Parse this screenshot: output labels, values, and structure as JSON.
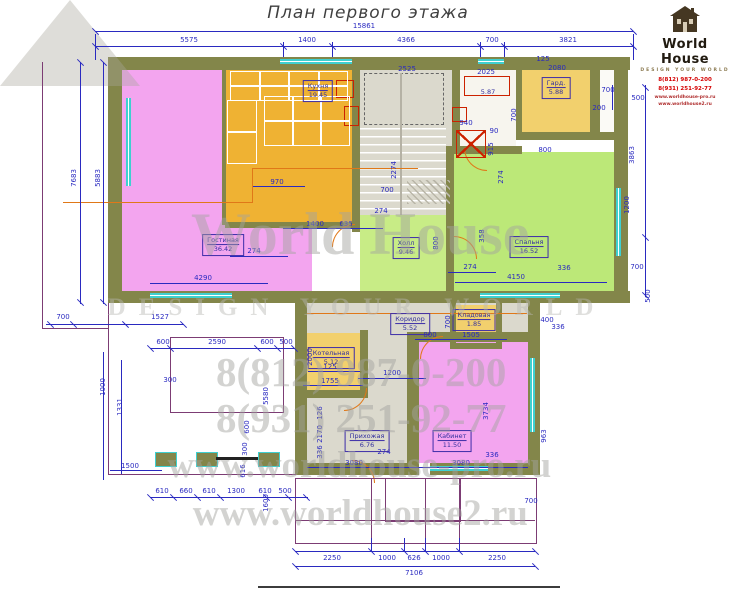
{
  "title": "План первого этажа",
  "logo": {
    "name": "World House",
    "tagline": "DESIGN YOUR WORLD",
    "phone1": "8(812) 987-0-200",
    "phone2": "8(931) 251-92-77",
    "site1": "www.worldhouse-pro.ru",
    "site2": "www.worldhouse2.ru"
  },
  "watermark": {
    "line1": "World House",
    "line2": "DESIGN YOUR WORLD",
    "line3": "8(812) 987-0-200",
    "line4": "8(931) 251-92-77",
    "line5": "www.worldhouse-pro.ru",
    "line6": "www.worldhouse2.ru"
  },
  "rooms": [
    {
      "name": "Кухня",
      "area": "19.45",
      "cx": 318,
      "cy": 91
    },
    {
      "name": "Гостиная",
      "area": "36.42",
      "cx": 223,
      "cy": 245
    },
    {
      "name": "Холл",
      "area": "9.46",
      "cx": 406,
      "cy": 248
    },
    {
      "name": "Спальня",
      "area": "16.52",
      "cx": 529,
      "cy": 247
    },
    {
      "name": "Гард.",
      "area": "5.88",
      "cx": 556,
      "cy": 88
    },
    {
      "name": "",
      "area": "5.87",
      "cx": 488,
      "cy": 92,
      "plain": true
    },
    {
      "name": "Котельная",
      "area": "5.12",
      "cx": 331,
      "cy": 358
    },
    {
      "name": "Коридор",
      "area": "5.52",
      "cx": 410,
      "cy": 324
    },
    {
      "name": "Кладовая",
      "area": "1.85",
      "cx": 474,
      "cy": 320
    },
    {
      "name": "Прихожая",
      "area": "6.76",
      "cx": 367,
      "cy": 441
    },
    {
      "name": "Кабинет",
      "area": "11.50",
      "cx": 452,
      "cy": 441
    }
  ],
  "dimensions": [
    {
      "t": "15861",
      "x": 364,
      "y": 26
    },
    {
      "t": "5575",
      "x": 189,
      "y": 40
    },
    {
      "t": "1400",
      "x": 307,
      "y": 40
    },
    {
      "t": "4366",
      "x": 406,
      "y": 40
    },
    {
      "t": "700",
      "x": 492,
      "y": 40
    },
    {
      "t": "3821",
      "x": 568,
      "y": 40
    },
    {
      "t": "7683",
      "x": 74,
      "y": 178,
      "v": 1
    },
    {
      "t": "5883",
      "x": 98,
      "y": 178,
      "v": 1
    },
    {
      "t": "700",
      "x": 63,
      "y": 317
    },
    {
      "t": "1527",
      "x": 160,
      "y": 317
    },
    {
      "t": "1000",
      "x": 103,
      "y": 387,
      "v": 1
    },
    {
      "t": "1331",
      "x": 120,
      "y": 407,
      "v": 1
    },
    {
      "t": "1500",
      "x": 130,
      "y": 466
    },
    {
      "t": "610",
      "x": 162,
      "y": 491
    },
    {
      "t": "660",
      "x": 186,
      "y": 491
    },
    {
      "t": "610",
      "x": 209,
      "y": 491
    },
    {
      "t": "1300",
      "x": 236,
      "y": 491
    },
    {
      "t": "610",
      "x": 265,
      "y": 491
    },
    {
      "t": "500",
      "x": 285,
      "y": 491
    },
    {
      "t": "600",
      "x": 163,
      "y": 342
    },
    {
      "t": "2590",
      "x": 217,
      "y": 342
    },
    {
      "t": "600",
      "x": 267,
      "y": 342
    },
    {
      "t": "500",
      "x": 286,
      "y": 342
    },
    {
      "t": "300",
      "x": 170,
      "y": 380
    },
    {
      "t": "2250",
      "x": 332,
      "y": 558
    },
    {
      "t": "1000",
      "x": 387,
      "y": 558
    },
    {
      "t": "626",
      "x": 414,
      "y": 558
    },
    {
      "t": "1000",
      "x": 441,
      "y": 558
    },
    {
      "t": "2250",
      "x": 497,
      "y": 558
    },
    {
      "t": "7106",
      "x": 414,
      "y": 573
    },
    {
      "t": "1600",
      "x": 266,
      "y": 503,
      "v": 1
    },
    {
      "t": "700",
      "x": 531,
      "y": 501
    },
    {
      "t": "700",
      "x": 608,
      "y": 90
    },
    {
      "t": "500",
      "x": 638,
      "y": 98
    },
    {
      "t": "200",
      "x": 599,
      "y": 108
    },
    {
      "t": "3863",
      "x": 632,
      "y": 155,
      "v": 1
    },
    {
      "t": "1200",
      "x": 627,
      "y": 205,
      "v": 1
    },
    {
      "t": "700",
      "x": 637,
      "y": 267
    },
    {
      "t": "500",
      "x": 648,
      "y": 296,
      "v": 1
    },
    {
      "t": "963",
      "x": 544,
      "y": 436,
      "v": 1
    },
    {
      "t": "3734",
      "x": 486,
      "y": 411,
      "v": 1
    },
    {
      "t": "2525",
      "x": 407,
      "y": 69
    },
    {
      "t": "2025",
      "x": 486,
      "y": 72
    },
    {
      "t": "940",
      "x": 466,
      "y": 123
    },
    {
      "t": "90",
      "x": 494,
      "y": 131
    },
    {
      "t": "915",
      "x": 491,
      "y": 149,
      "v": 1
    },
    {
      "t": "274",
      "x": 501,
      "y": 177,
      "v": 1
    },
    {
      "t": "125",
      "x": 543,
      "y": 59
    },
    {
      "t": "2080",
      "x": 557,
      "y": 68
    },
    {
      "t": "700",
      "x": 514,
      "y": 115,
      "v": 1
    },
    {
      "t": "800",
      "x": 545,
      "y": 150
    },
    {
      "t": "970",
      "x": 277,
      "y": 182
    },
    {
      "t": "1400",
      "x": 315,
      "y": 224
    },
    {
      "t": "635",
      "x": 346,
      "y": 224
    },
    {
      "t": "700",
      "x": 387,
      "y": 190
    },
    {
      "t": "274",
      "x": 381,
      "y": 211
    },
    {
      "t": "2274",
      "x": 394,
      "y": 170,
      "v": 1
    },
    {
      "t": "4290",
      "x": 203,
      "y": 278
    },
    {
      "t": "274",
      "x": 254,
      "y": 251
    },
    {
      "t": "800",
      "x": 436,
      "y": 243,
      "v": 1
    },
    {
      "t": "274",
      "x": 470,
      "y": 267
    },
    {
      "t": "358",
      "x": 482,
      "y": 236,
      "v": 1
    },
    {
      "t": "336",
      "x": 564,
      "y": 268
    },
    {
      "t": "4150",
      "x": 516,
      "y": 277
    },
    {
      "t": "2000",
      "x": 310,
      "y": 357,
      "v": 1
    },
    {
      "t": "125",
      "x": 330,
      "y": 367
    },
    {
      "t": "1755",
      "x": 330,
      "y": 381
    },
    {
      "t": "1200",
      "x": 392,
      "y": 373
    },
    {
      "t": "5580",
      "x": 266,
      "y": 396,
      "v": 1
    },
    {
      "t": "600",
      "x": 247,
      "y": 427,
      "v": 1
    },
    {
      "t": "300",
      "x": 245,
      "y": 449,
      "v": 1
    },
    {
      "t": "616",
      "x": 243,
      "y": 471,
      "v": 1
    },
    {
      "t": "126",
      "x": 320,
      "y": 413,
      "v": 1
    },
    {
      "t": "2170",
      "x": 320,
      "y": 434,
      "v": 1
    },
    {
      "t": "336",
      "x": 320,
      "y": 452,
      "v": 1
    },
    {
      "t": "3080",
      "x": 354,
      "y": 463
    },
    {
      "t": "274",
      "x": 384,
      "y": 452
    },
    {
      "t": "3080",
      "x": 461,
      "y": 463
    },
    {
      "t": "336",
      "x": 492,
      "y": 455
    },
    {
      "t": "800",
      "x": 430,
      "y": 335
    },
    {
      "t": "1505",
      "x": 471,
      "y": 335
    },
    {
      "t": "400",
      "x": 547,
      "y": 320
    },
    {
      "t": "336",
      "x": 558,
      "y": 327
    },
    {
      "t": "700",
      "x": 448,
      "y": 322,
      "v": 1
    }
  ]
}
